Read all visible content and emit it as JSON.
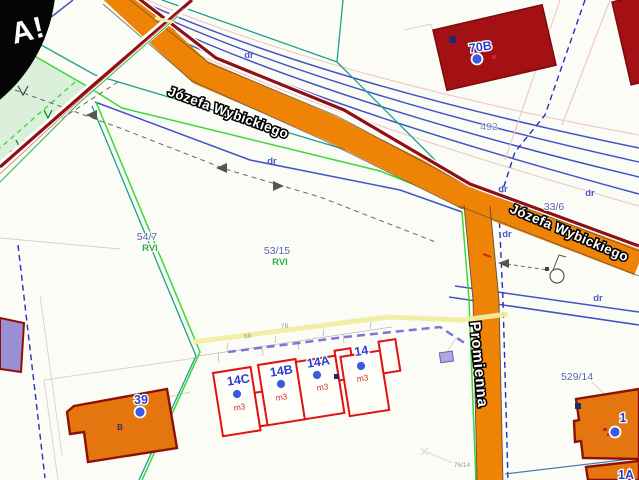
{
  "watermark": {
    "text": "A!"
  },
  "streets": {
    "wybickiego_upper": "Józefa Wybickiego",
    "wybickiego_lower": "Józefa Wybickiego",
    "promienna": "Promienna"
  },
  "parcels": {
    "p54_7": {
      "number": "54/7",
      "land_class": "RVI"
    },
    "p53_15": {
      "number": "53/15",
      "land_class": "RVI"
    },
    "p529_14": {
      "number": "529/14"
    },
    "p33_6": {
      "number": "33/6"
    },
    "p492": {
      "number": "492"
    },
    "p76_14": {
      "number": "76/14"
    }
  },
  "buildings": {
    "b70B": {
      "label": "70B"
    },
    "b39": {
      "label": "39",
      "letter": "B"
    },
    "b14C": {
      "label": "14C",
      "usage": "m3"
    },
    "b14B": {
      "label": "14B",
      "usage": "m3"
    },
    "b14A": {
      "label": "14A",
      "usage": "m3"
    },
    "b14": {
      "label": "14",
      "usage": "m3"
    },
    "b1": {
      "label": "1"
    },
    "b1A": {
      "label": "1A"
    }
  },
  "road_class_labels": {
    "dr1": "dr",
    "dr2": "dr",
    "dr3": "dr",
    "dr4": "dr",
    "dr5": "dr",
    "dr6": "dr"
  },
  "measurements": {
    "m1": "68",
    "m2": "78"
  },
  "colors": {
    "road_fill": "#ee8306",
    "boundary_maroon": "#8f1012",
    "building_fill_dark": "#a31114",
    "building_fill_orange": "#e4750f",
    "building_outline_red": "#e01212",
    "label_blue": "#2a3fd0",
    "green_area": "#daf0da",
    "utility_navy": "#4353c6",
    "teal_boundary": "#1f9e8e",
    "bright_green": "#39d839",
    "highlight_yellow": "#f2eda0",
    "violet_dashed": "#8273d6"
  }
}
